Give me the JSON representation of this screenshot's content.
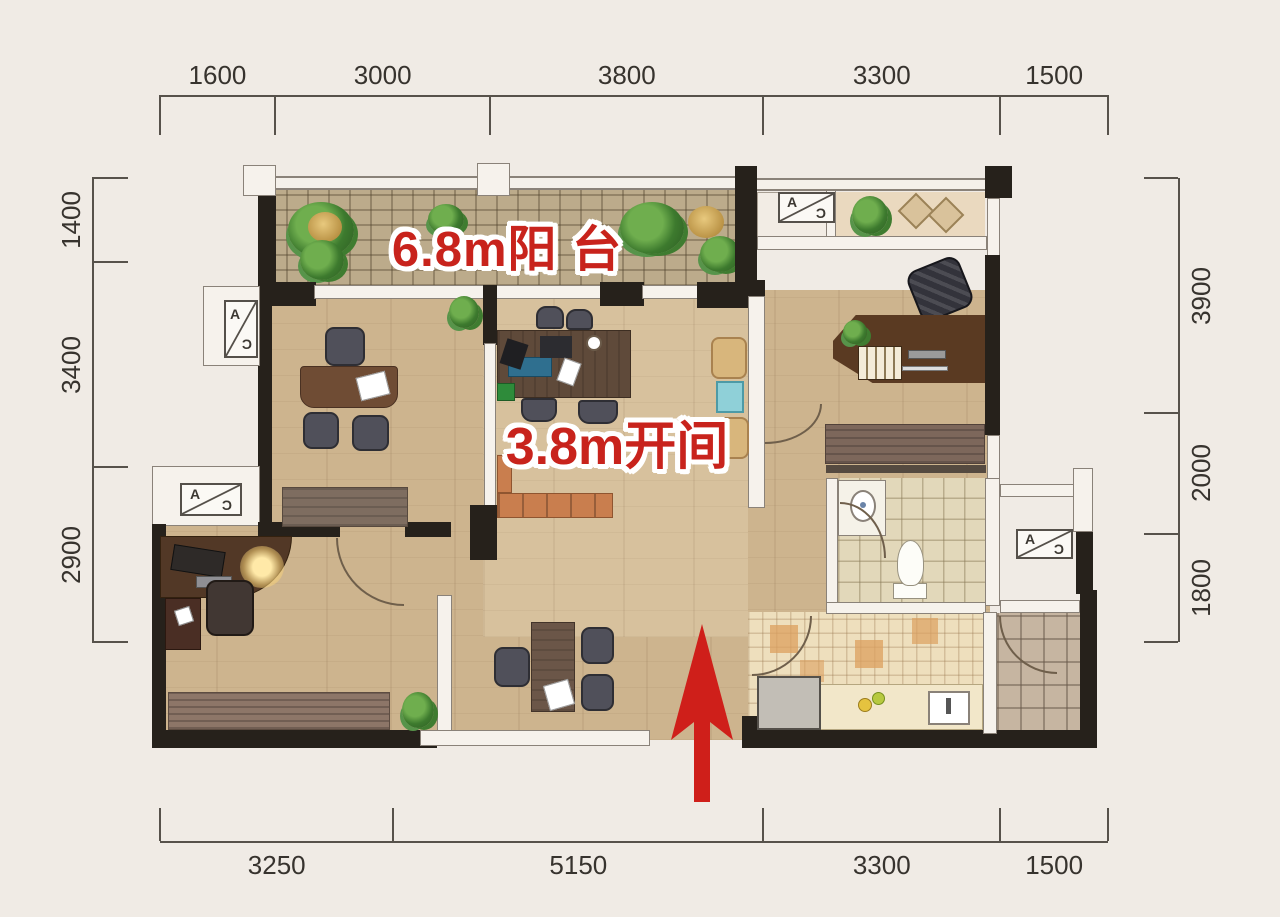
{
  "annotations": {
    "balcony_label": "6.8m阳 台",
    "bay_label": "3.8m开间"
  },
  "dimensions": {
    "top": [
      "1600",
      "3000",
      "3800",
      "3300",
      "1500"
    ],
    "bottom": [
      "3250",
      "5150",
      "3300",
      "1500"
    ],
    "left": [
      "1400",
      "3400",
      "2900"
    ],
    "right": [
      "3900",
      "2000",
      "1800"
    ]
  },
  "ac_label": {
    "a": "A",
    "c": "C"
  },
  "colors": {
    "red": "#c8231c",
    "wall": "#26211b",
    "wood": "#cdb48e",
    "background": "#f0ebe5"
  }
}
